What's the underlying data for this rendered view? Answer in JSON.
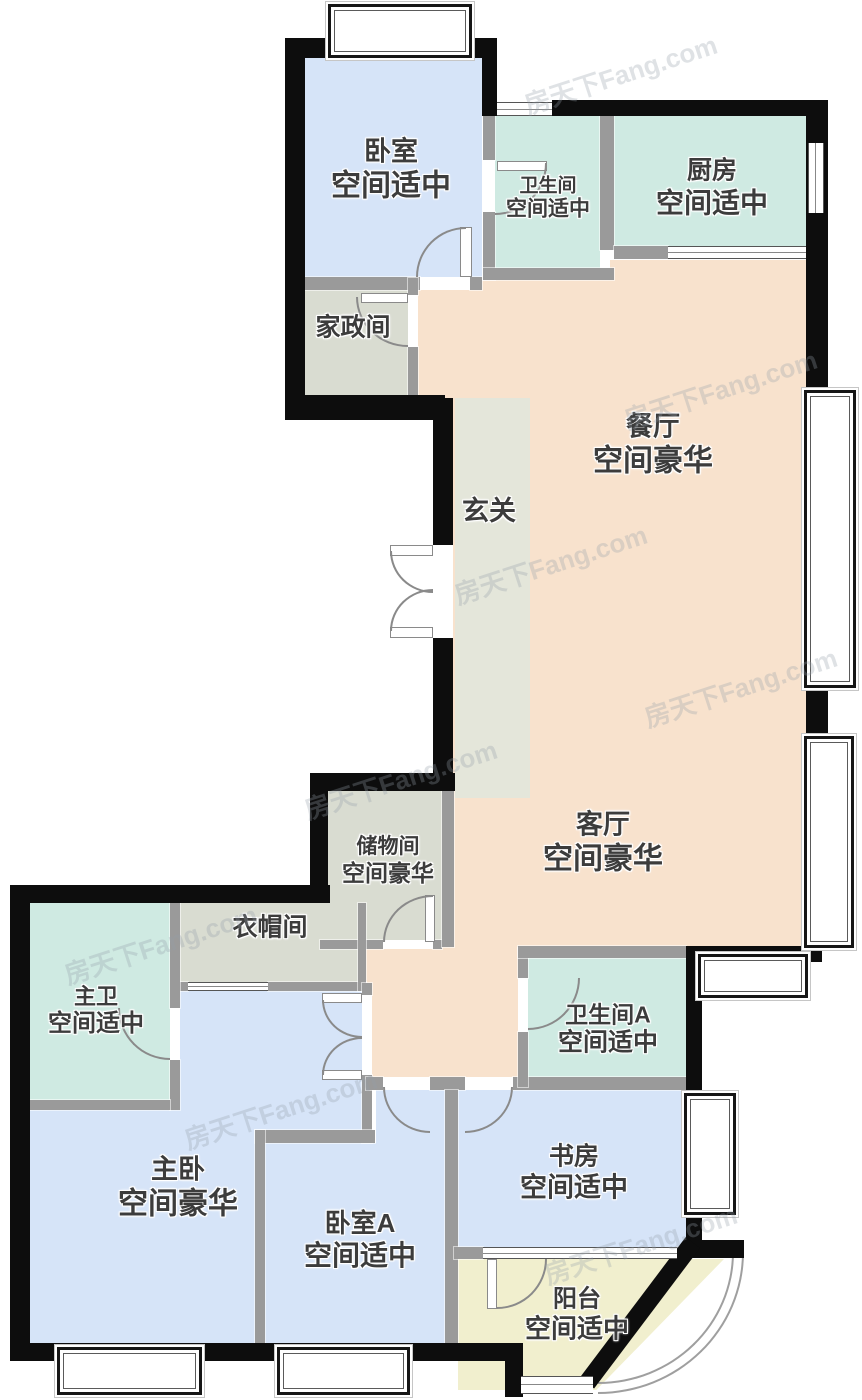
{
  "watermark": "房天下Fang.com",
  "colors": {
    "bedroom_fill": "#d6e4f8",
    "wet_area_fill": "#cfeae2",
    "public_area_fill": "#f8e2cd",
    "utility_fill": "#d9dcd1",
    "foyer_fill": "#e4e6da",
    "balcony_fill": "#f1efce",
    "exterior_wall": "#0d0d0d",
    "partition_wall": "#9a9a9a",
    "label_text": "#3c3c3c"
  },
  "rooms": {
    "bedroom": {
      "name": "卧室",
      "grade": "空间适中"
    },
    "bathroom": {
      "name": "卫生间",
      "grade": "空间适中"
    },
    "kitchen": {
      "name": "厨房",
      "grade": "空间适中"
    },
    "housekeeping": {
      "name": "家政间"
    },
    "dining": {
      "name": "餐厅",
      "grade": "空间豪华"
    },
    "foyer": {
      "name": "玄关"
    },
    "living": {
      "name": "客厅",
      "grade": "空间豪华"
    },
    "storage": {
      "name": "储物间",
      "grade": "空间豪华"
    },
    "cloakroom": {
      "name": "衣帽间"
    },
    "master_bath": {
      "name": "主卫",
      "grade": "空间适中"
    },
    "master_bedroom": {
      "name": "主卧",
      "grade": "空间豪华"
    },
    "bedroom_a": {
      "name": "卧室A",
      "grade": "空间适中"
    },
    "bathroom_a": {
      "name": "卫生间A",
      "grade": "空间适中"
    },
    "study": {
      "name": "书房",
      "grade": "空间适中"
    },
    "balcony": {
      "name": "阳台",
      "grade": "空间适中"
    }
  }
}
